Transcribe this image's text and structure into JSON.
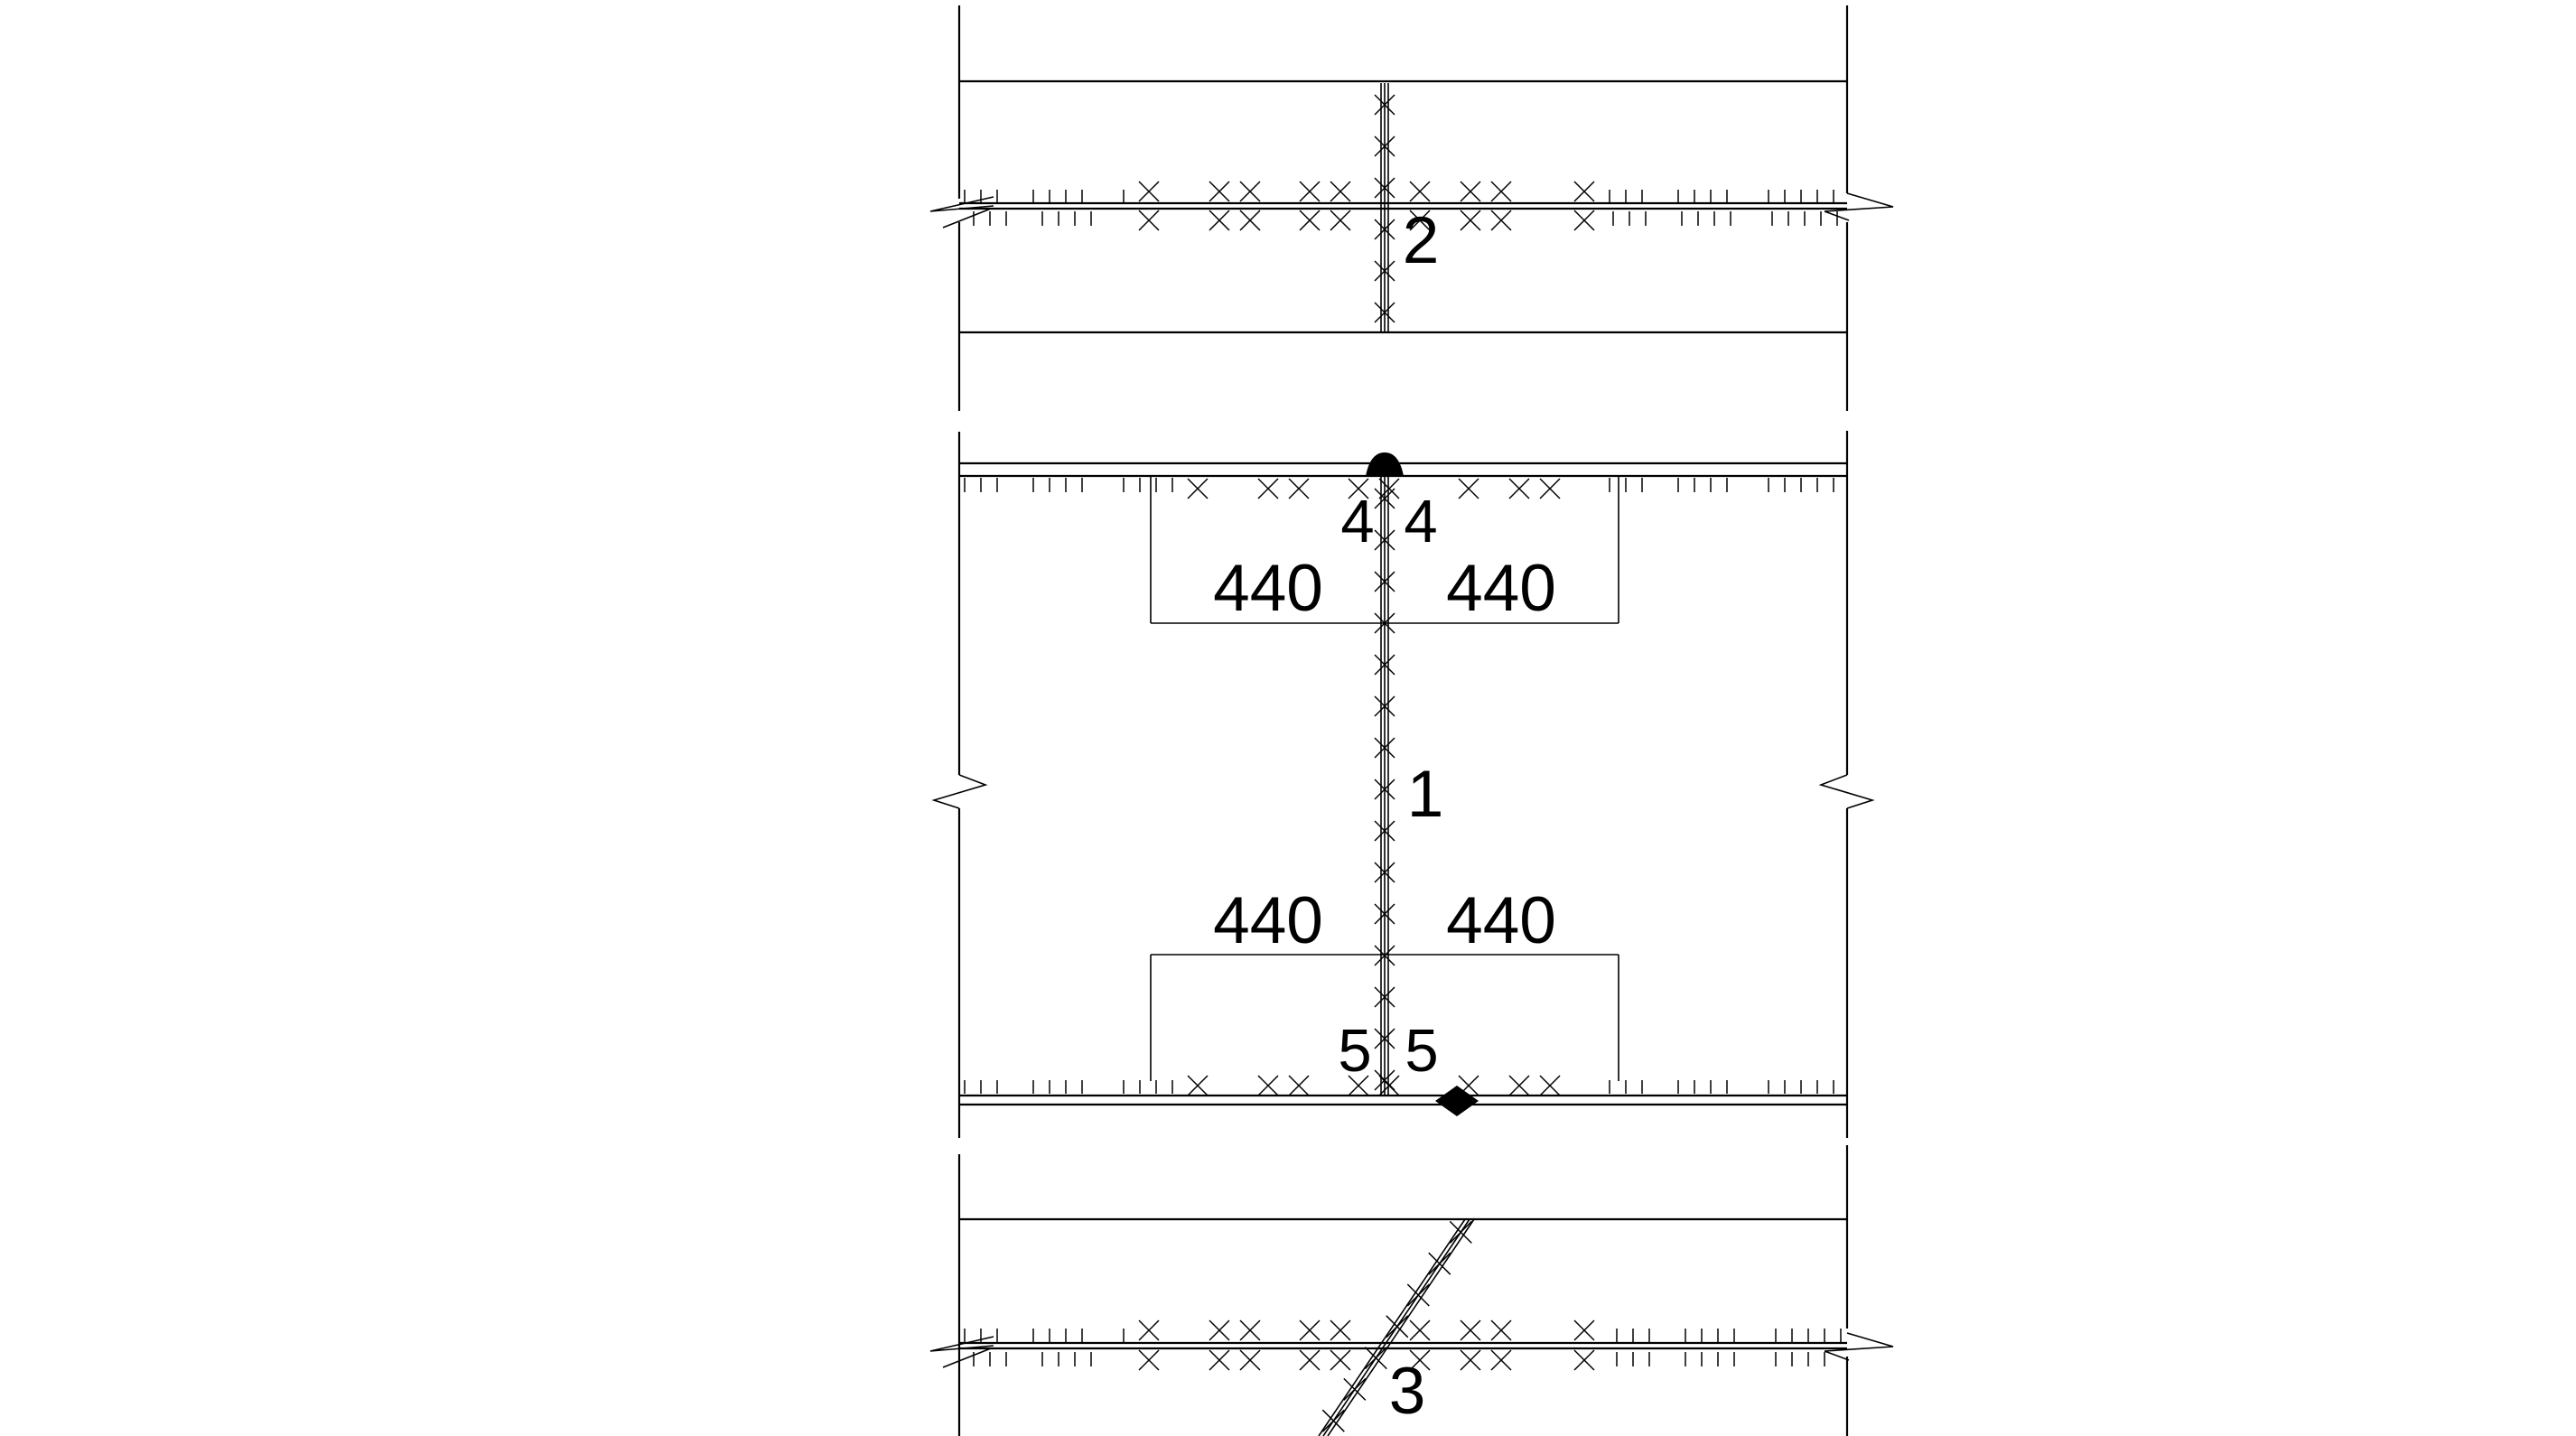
{
  "drawing": {
    "type": "weld-detail-technical-drawing",
    "colors": {
      "stroke": "#000000",
      "background": "#ffffff",
      "marker_fill": "#000000"
    },
    "welds": {
      "top_section": {
        "number": "2"
      },
      "middle_section": {
        "number": "1",
        "top_size_left": "4",
        "top_size_right": "4",
        "bottom_size_left": "5",
        "bottom_size_right": "5",
        "dim_top_left": "440",
        "dim_top_right": "440",
        "dim_bottom_left": "440",
        "dim_bottom_right": "440"
      },
      "bottom_section": {
        "number": "3"
      }
    }
  }
}
